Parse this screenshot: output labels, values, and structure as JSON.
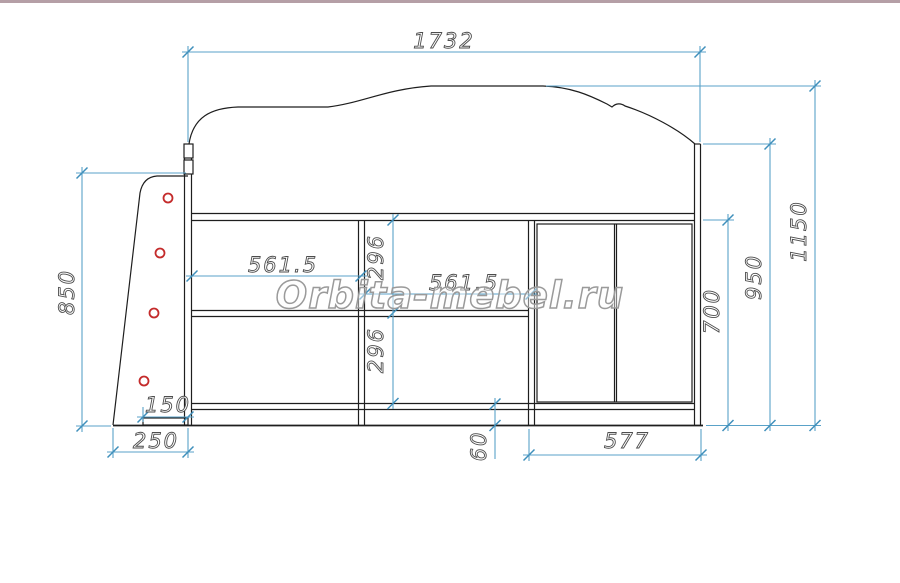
{
  "source_watermark": {
    "text": "Orbita-mebel.ru"
  },
  "drawing": {
    "type": "furniture technical drawing - front elevation",
    "subject": "loft bed with under-bed shelving, two-door wardrobe and side ladder",
    "units": "mm"
  },
  "colors": {
    "background": "#ffffff",
    "structure_line": "#1e1e1e",
    "dimension_line": "#5aa2c8",
    "dimension_text_outline": "#4d4d4d",
    "ladder_hole": "#c42b2b",
    "watermark": "#9a9a9a",
    "page_top_border": "#b59fa6"
  },
  "dimensions": {
    "total_width": "1732",
    "overall_height": "1150",
    "bed_side_height": "950",
    "under_bed_clearance": "700",
    "ladder_height": "850",
    "left_compartment_width": "561.5",
    "right_compartment_width": "561.5",
    "upper_shelf_height": "296",
    "lower_shelf_height": "296",
    "ladder_step_width": "150",
    "ladder_base_width": "250",
    "plinth_height": "60",
    "wardrobe_width": "577"
  }
}
